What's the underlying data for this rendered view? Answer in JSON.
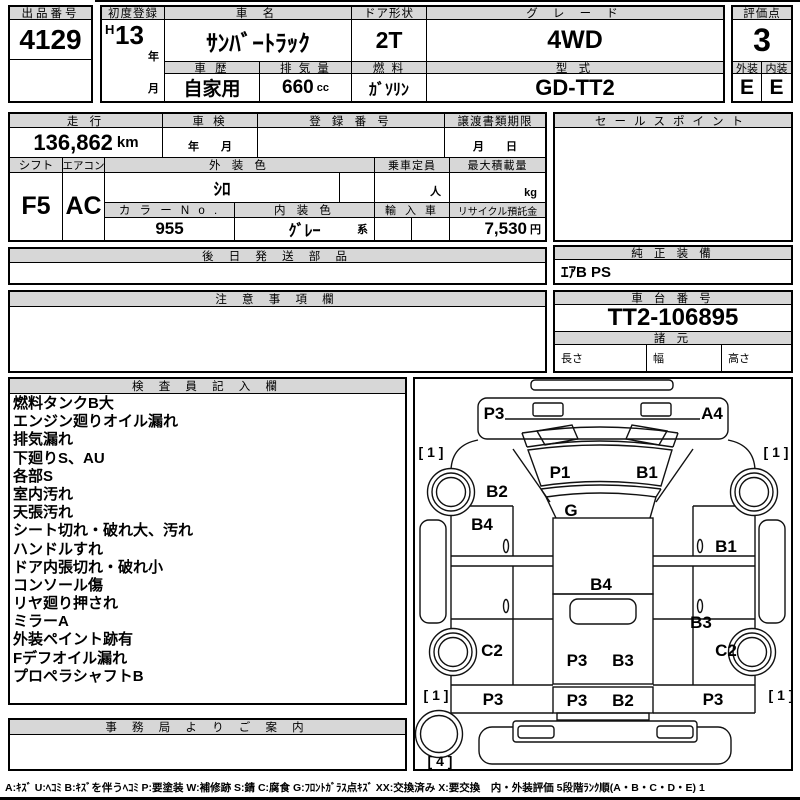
{
  "header": {
    "lot": {
      "label": "出品番号",
      "value": "4129"
    },
    "first_reg": {
      "label": "初度登録",
      "era": "H",
      "year": "13",
      "year_suffix": "年",
      "month_suffix": "月"
    },
    "car_name": {
      "label": "車 名",
      "value": "ｻﾝﾊﾞｰﾄﾗｯｸ"
    },
    "door": {
      "label": "ドア形状",
      "value": "2T"
    },
    "grade": {
      "label": "グ レ ー ド",
      "value": "4WD"
    },
    "score": {
      "label": "評価点",
      "value": "3"
    },
    "history": {
      "label": "車 歴",
      "value": "自家用"
    },
    "displacement": {
      "label": "排 気 量",
      "value": "660",
      "unit": "cc"
    },
    "fuel": {
      "label": "燃 料",
      "value": "ｶﾞｿﾘﾝ"
    },
    "model_code": {
      "label": "型 式",
      "value": "GD-TT2"
    },
    "exterior": {
      "label": "外装",
      "value": "E"
    },
    "interior": {
      "label": "内装",
      "value": "E"
    }
  },
  "running": {
    "mileage": {
      "label": "走 行",
      "value": "136,862",
      "unit": "km"
    },
    "inspection": {
      "label": "車 検",
      "placeholder": "年　　月"
    },
    "reg_no": {
      "label": "登 録 番 号",
      "value": ""
    },
    "transfer": {
      "label": "譲渡書類期限",
      "placeholder": "月　　日"
    },
    "sales_point": {
      "label": "セールスポイント",
      "value": ""
    }
  },
  "equipment": {
    "shift": {
      "label": "シフト",
      "value": "F5"
    },
    "aircon": {
      "label": "エアコン",
      "value": "AC"
    },
    "ext_color": {
      "label": "外 装 色",
      "value": "ｼﾛ"
    },
    "color_no": {
      "label": "カ ラ ー N o .",
      "value": "955"
    },
    "int_color": {
      "label": "内 装 色",
      "value": "ｸﾞﾚｰ",
      "suffix": "系"
    },
    "capacity": {
      "label": "乗車定員",
      "unit": "人"
    },
    "max_load": {
      "label": "最大積載量",
      "unit": "kg"
    },
    "import": {
      "label": "輸 入 車"
    },
    "recycle": {
      "label": "リサイクル預託金",
      "value": "7,530",
      "unit": "円"
    }
  },
  "sections": {
    "later_parts": {
      "label": "後 日 発 送 部 品",
      "value": ""
    },
    "oem_equip": {
      "label": "純 正 装 備",
      "value": "ｴｱB PS"
    },
    "notes": {
      "label": "注 意 事 項 欄",
      "value": ""
    },
    "chassis": {
      "label": "車 台 番 号",
      "value": "TT2-106895"
    },
    "specs": {
      "label": "諸 元",
      "dims": [
        {
          "label": "長さ",
          "value": ""
        },
        {
          "label": "幅",
          "value": ""
        },
        {
          "label": "高さ",
          "value": ""
        }
      ]
    },
    "inspector": {
      "label": "検 査 員 記 入 欄",
      "lines": [
        "燃料タンクB大",
        "エンジン廻りオイル漏れ",
        "排気漏れ",
        "下廻りS、AU",
        "各部S",
        "室内汚れ",
        "天張汚れ",
        "シート切れ・破れ大、汚れ",
        "ハンドルすれ",
        "ドア内張切れ・破れ小",
        "コンソール傷",
        "リヤ廻り押され",
        "ミラーA",
        "外装ペイント跡有",
        "Fデフオイル漏れ",
        "プロペラシャフトB"
      ]
    },
    "office": {
      "label": "事 務 局 よ り ご 案 内",
      "value": ""
    }
  },
  "diagram": {
    "labels": [
      {
        "t": "P3",
        "x": 494,
        "y": 419,
        "fs": 17
      },
      {
        "t": "A4",
        "x": 712,
        "y": 419,
        "fs": 17
      },
      {
        "t": "[ 1 ]",
        "x": 431,
        "y": 457,
        "fs": 14
      },
      {
        "t": "[ 1 ]",
        "x": 776,
        "y": 457,
        "fs": 14
      },
      {
        "t": "P1",
        "x": 560,
        "y": 478,
        "fs": 17
      },
      {
        "t": "B1",
        "x": 647,
        "y": 478,
        "fs": 17
      },
      {
        "t": "B2",
        "x": 497,
        "y": 497,
        "fs": 17
      },
      {
        "t": "G",
        "x": 571,
        "y": 516,
        "fs": 17
      },
      {
        "t": "B4",
        "x": 482,
        "y": 530,
        "fs": 17
      },
      {
        "t": "B1",
        "x": 726,
        "y": 552,
        "fs": 17
      },
      {
        "t": "B4",
        "x": 601,
        "y": 590,
        "fs": 17
      },
      {
        "t": "B3",
        "x": 701,
        "y": 628,
        "fs": 17
      },
      {
        "t": "C2",
        "x": 492,
        "y": 656,
        "fs": 17
      },
      {
        "t": "C2",
        "x": 726,
        "y": 656,
        "fs": 17
      },
      {
        "t": "P3",
        "x": 577,
        "y": 666,
        "fs": 17
      },
      {
        "t": "B3",
        "x": 623,
        "y": 666,
        "fs": 17
      },
      {
        "t": "P3",
        "x": 493,
        "y": 705,
        "fs": 17
      },
      {
        "t": "P3",
        "x": 713,
        "y": 705,
        "fs": 17
      },
      {
        "t": "P3",
        "x": 577,
        "y": 706,
        "fs": 17
      },
      {
        "t": "B2",
        "x": 623,
        "y": 706,
        "fs": 17
      },
      {
        "t": "[ 1 ]",
        "x": 436,
        "y": 700,
        "fs": 14
      },
      {
        "t": "[ 1 ]",
        "x": 781,
        "y": 700,
        "fs": 14
      },
      {
        "t": "[ 4 ]",
        "x": 440,
        "y": 766,
        "fs": 14
      }
    ]
  },
  "legend": "A:ｷｽﾞ U:ﾍｺﾐ B:ｷｽﾞを伴うﾍｺﾐ P:要塗装 W:補修跡 S:錆 C:腐食 G:ﾌﾛﾝﾄｶﾞﾗｽ点ｷｽﾞ XX:交換済み X:要交換　内・外装評価 5段階ﾗﾝｸ順(A・B・C・D・E) 1",
  "colors": {
    "header_bg": "#d7d7d7",
    "border": "#000000",
    "background": "#ffffff"
  }
}
